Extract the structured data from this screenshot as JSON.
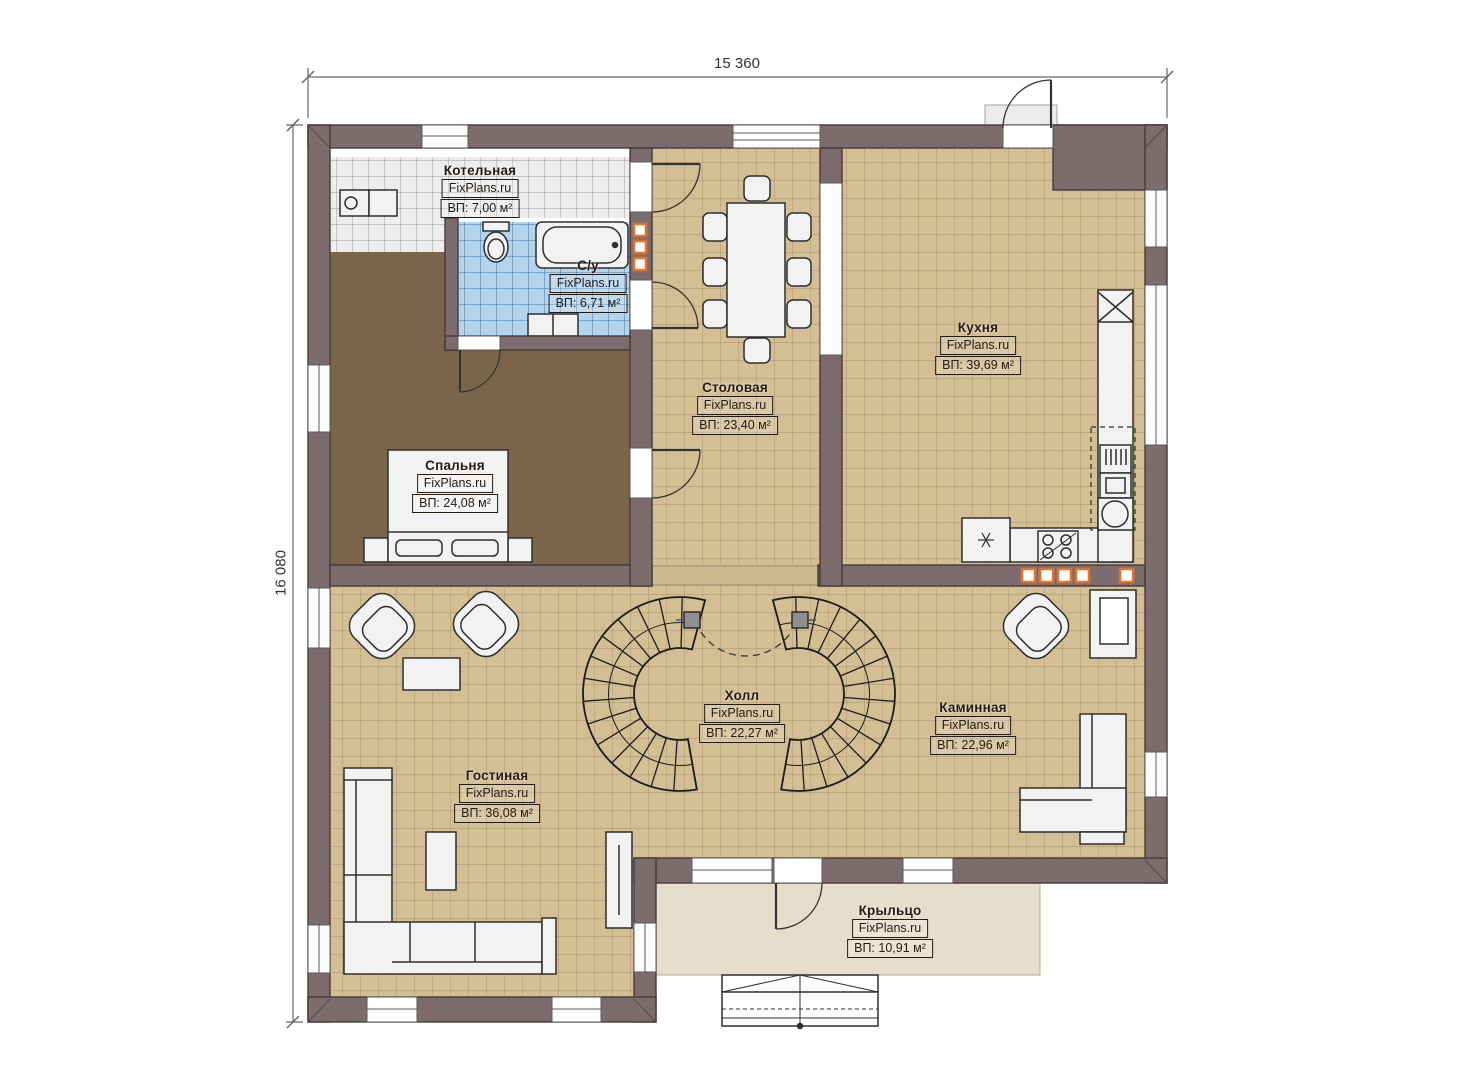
{
  "plan": {
    "dimensions": {
      "width_label": "15 360",
      "height_label": "16 080"
    },
    "rooms": [
      {
        "name": "Котельная",
        "site": "FixPlans.ru",
        "area": "ВП: 7,00 м²"
      },
      {
        "name": "С/у",
        "site": "FixPlans.ru",
        "area": "ВП: 6,71 м²"
      },
      {
        "name": "Спальня",
        "site": "FixPlans.ru",
        "area": "ВП: 24,08 м²"
      },
      {
        "name": "Столовая",
        "site": "FixPlans.ru",
        "area": "ВП: 23,40 м²"
      },
      {
        "name": "Кухня",
        "site": "FixPlans.ru",
        "area": "ВП: 39,69 м²"
      },
      {
        "name": "Холл",
        "site": "FixPlans.ru",
        "area": "ВП: 22,27 м²"
      },
      {
        "name": "Каминная",
        "site": "FixPlans.ru",
        "area": "ВП: 22,96 м²"
      },
      {
        "name": "Гостиная",
        "site": "FixPlans.ru",
        "area": "ВП: 36,08 м²"
      },
      {
        "name": "Крыльцо",
        "site": "FixPlans.ru",
        "area": "ВП: 10,91 м²"
      }
    ],
    "colors": {
      "wall": "#7d6c6d",
      "floor_tile": "#d4bf94",
      "bedroom_floor": "#7a654b",
      "bathroom_tile": "#b3d4ec",
      "boiler_tile": "#ededed",
      "porch_floor": "#e7ddcb",
      "vent_marker": "#e4732a",
      "furniture": "#f2f2f2"
    }
  }
}
